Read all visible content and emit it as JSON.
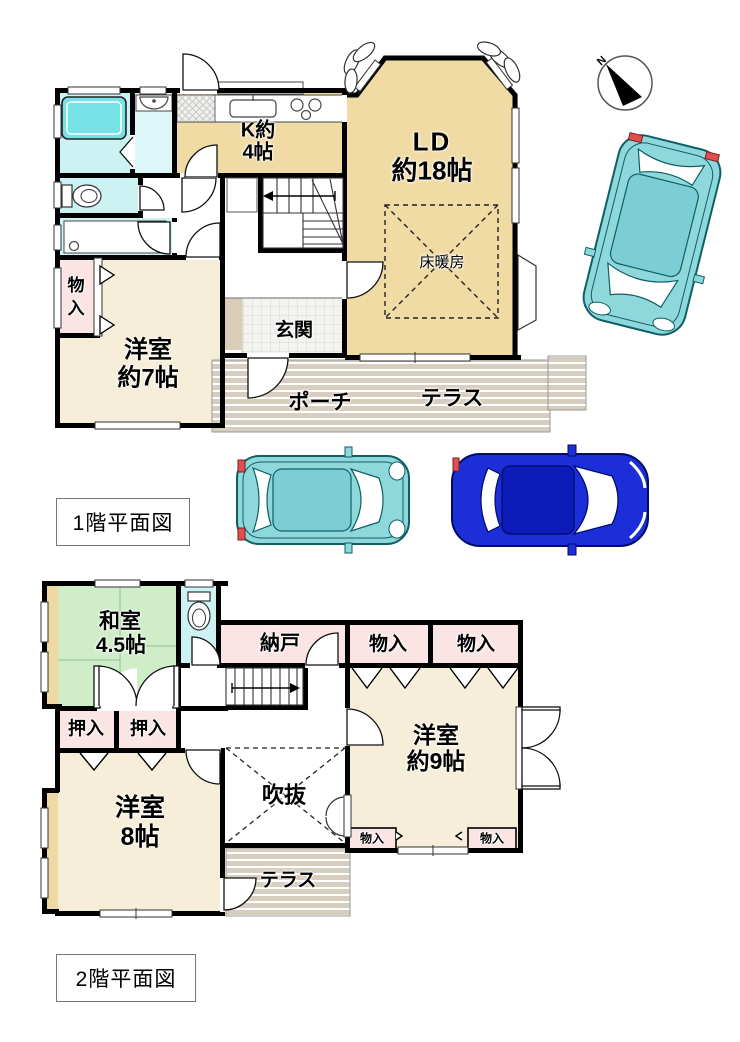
{
  "floor1": {
    "title": "1階平面図",
    "labels": {
      "kitchen_l1": "K約",
      "kitchen_l2": "4帖",
      "ld_l1": "LD",
      "ld_l2": "約18帖",
      "floor_heating": "床暖房",
      "entrance": "玄関",
      "porch": "ポーチ",
      "terrace": "テラス",
      "storage_l1": "物",
      "storage_l2": "入",
      "west7_l1": "洋室",
      "west7_l2": "約7帖"
    }
  },
  "floor2": {
    "title": "2階平面図",
    "labels": {
      "japanese_l1": "和室",
      "japanese_l2": "4.5帖",
      "nando": "納戸",
      "oshiire": [
        "押入",
        "押入"
      ],
      "monoiri_top": [
        "物入",
        "物入"
      ],
      "west9_l1": "洋室",
      "west9_l2": "約9帖",
      "monoiri_small": [
        "物入",
        "物入"
      ],
      "west8_l1": "洋室",
      "west8_l2": "8帖",
      "void": "吹抜",
      "terrace": "テラス"
    }
  },
  "compass": {
    "north": "N"
  },
  "colors": {
    "wall": "#000000",
    "room_tan": "#f1dba4",
    "room_cream": "#f6eed8",
    "room_green": "#cfeec8",
    "room_pink": "#fbe4e4",
    "room_cyan": "#ccf2f4",
    "room_cyan_light": "#ddf7f8",
    "tub": "#76e2e8",
    "bay": "#eed9a2",
    "stripe": "#d8cec0",
    "tile": "#f3f3ef",
    "step": "#d9ccb8",
    "car_teal": "#8ed7db",
    "car_teal_roof": "#7cced4",
    "car_blue": "#1b2ed8",
    "car_blue_roof": "#0d1cb8",
    "taillight_red": "#e05050"
  }
}
